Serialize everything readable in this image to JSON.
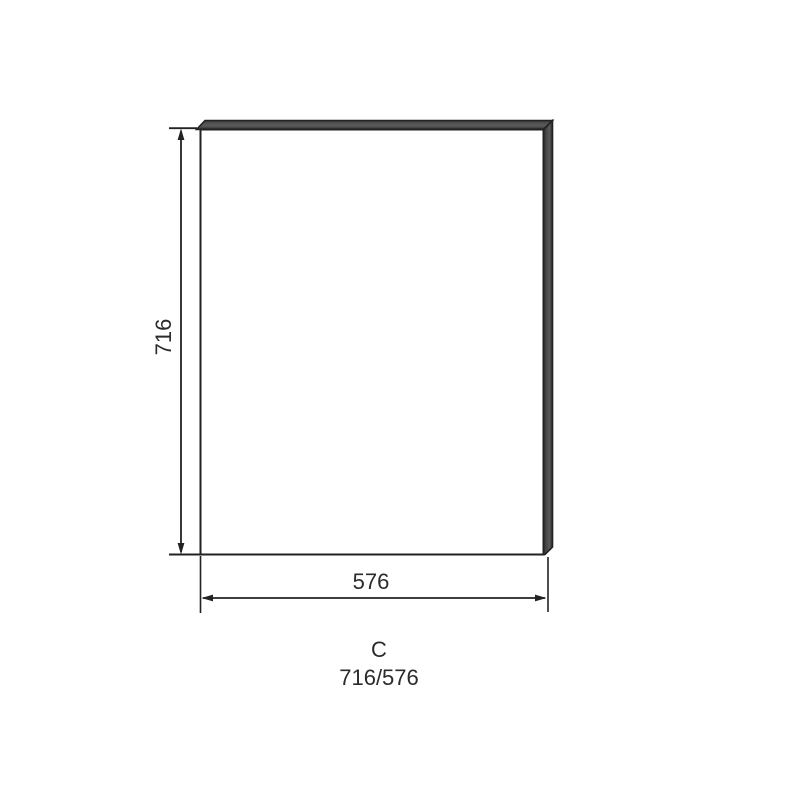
{
  "drawing": {
    "type": "panel-dimension-diagram",
    "height_dimension": "716",
    "width_dimension": "576",
    "item_label": "C",
    "item_size": "716/576",
    "colors": {
      "line": "#222222",
      "text": "#2b2b2b",
      "edge_dark": "#38383a",
      "edge_mid": "#4a4a4d",
      "edge_light": "#5a5a5d",
      "face_fill": "#ffffff",
      "background": "#ffffff"
    }
  }
}
